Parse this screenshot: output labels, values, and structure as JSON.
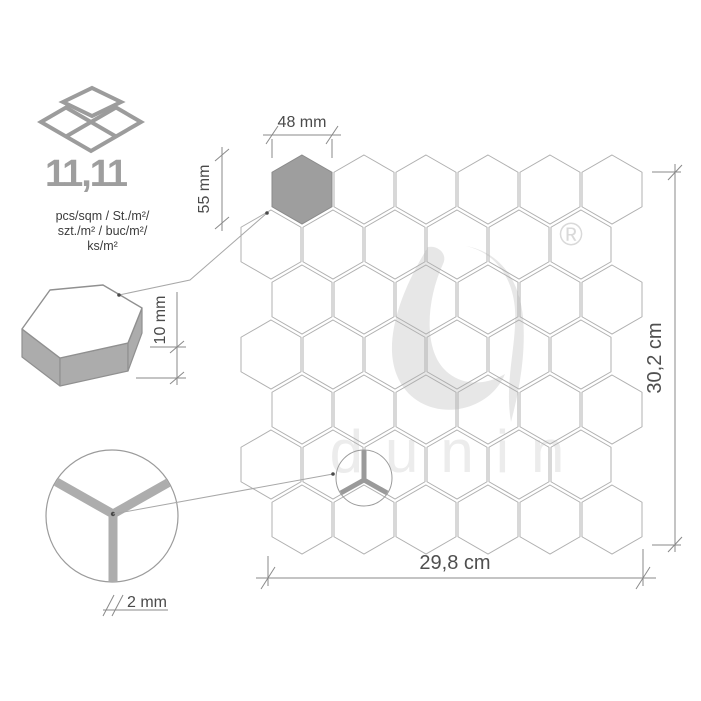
{
  "stats": {
    "value": "11,11",
    "units_lines": [
      "pcs/sqm / St./m²/",
      "szt./m² / buc/m²/",
      "ks/m²"
    ],
    "icon": "stacked-mosaic-tiles-icon"
  },
  "dimensions": {
    "chip_width": "48 mm",
    "chip_height": "55 mm",
    "thickness": "10 mm",
    "grout_width": "2 mm",
    "sheet_width": "29,8 cm",
    "sheet_height": "30,2 cm"
  },
  "brand": {
    "watermark_text": "dunin",
    "registered_mark": "®"
  },
  "mosaic": {
    "rows": 7,
    "cols": 6,
    "hex_w": 60,
    "hex_h": 69,
    "pitch_x": 62,
    "pitch_y": 55,
    "origin_x_odd": 272,
    "origin_x_even": 241,
    "origin_y": 155,
    "highlighted": {
      "row": 0,
      "col": 0
    },
    "outline_color": "#b0b0b0",
    "highlight_fill": "#9e9e9e"
  },
  "colors": {
    "background": "#ffffff",
    "dimension_lines": "#8a8a8a",
    "dimension_text": "#4a4a4a",
    "stats_value": "#9e9e9e",
    "watermark": "#e7e7e7",
    "grout": "#adadad"
  }
}
